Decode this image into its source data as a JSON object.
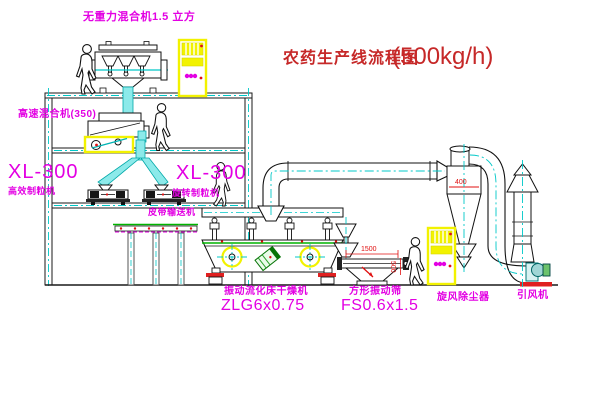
{
  "title": {
    "name": "农药生产线流程图",
    "capacity": "(500kg/h)"
  },
  "equipment_labels": {
    "gravity_free_mixer": "无重力混合机1.5 立方",
    "high_speed_mixer": "高速混合机(350)",
    "granulator_left_model": "XL-300",
    "granulator_left_name": "高效制粒机",
    "granulator_right_model": "XL-300",
    "granulator_right_name": "旋转制粒机",
    "belt_conveyor": "皮带输送机",
    "fluid_bed_dryer_name": "振动流化床干燥机",
    "fluid_bed_dryer_model": "ZLG6x0.75",
    "square_sieve_name": "方形振动筛",
    "square_sieve_model": "FS0.6x1.5",
    "cyclone": "旋风除尘器",
    "induced_draft_fan": "引风机"
  },
  "dimensions": {
    "cyclone_dim": "400",
    "sieve_length": "1500",
    "sieve_height": "500"
  },
  "colors": {
    "line": "#1a1a1a",
    "centerline_cyan": "#00c8c8",
    "pipe_fill_cyan": "#8ceaea",
    "label_magenta": "#e300e3",
    "title_red": "#c62828",
    "dimension_red": "#e01010",
    "highlight_yellow": "#f2f200",
    "belt_green": "#00b400",
    "base_red": "#e02020"
  }
}
